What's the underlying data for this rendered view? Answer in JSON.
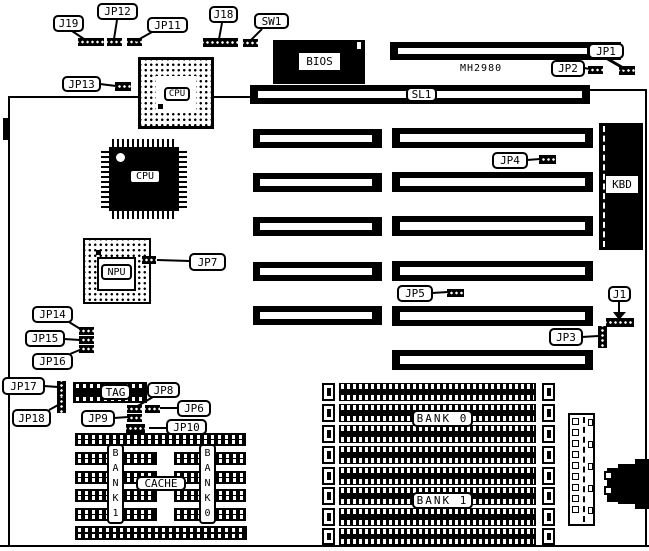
{
  "board": {
    "model": "MH2980"
  },
  "chips": {
    "bios": "BIOS",
    "cpu_socket": "CPU",
    "cpu": "CPU",
    "npu": "NPU",
    "kbd": "KBD",
    "tag": "TAG",
    "cache": "CACHE",
    "bank1_col": "BANK1",
    "bank0_col": "BANK0"
  },
  "slots": {
    "sl1": "SL1"
  },
  "memory": {
    "bank0": "BANK 0",
    "bank1": "BANK 1"
  },
  "callouts": {
    "j19": "J19",
    "jp12": "JP12",
    "jp11": "JP11",
    "j18": "J18",
    "sw1": "SW1",
    "jp1": "JP1",
    "jp2": "JP2",
    "jp13": "JP13",
    "jp4": "JP4",
    "jp7": "JP7",
    "jp5": "JP5",
    "j1": "J1",
    "jp3": "JP3",
    "jp14": "JP14",
    "jp15": "JP15",
    "jp16": "JP16",
    "jp17": "JP17",
    "jp18": "JP18",
    "jp8": "JP8",
    "jp6": "JP6",
    "jp9": "JP9",
    "jp10": "JP10"
  },
  "colors": {
    "ink": "#000000",
    "paper": "#ffffff"
  }
}
